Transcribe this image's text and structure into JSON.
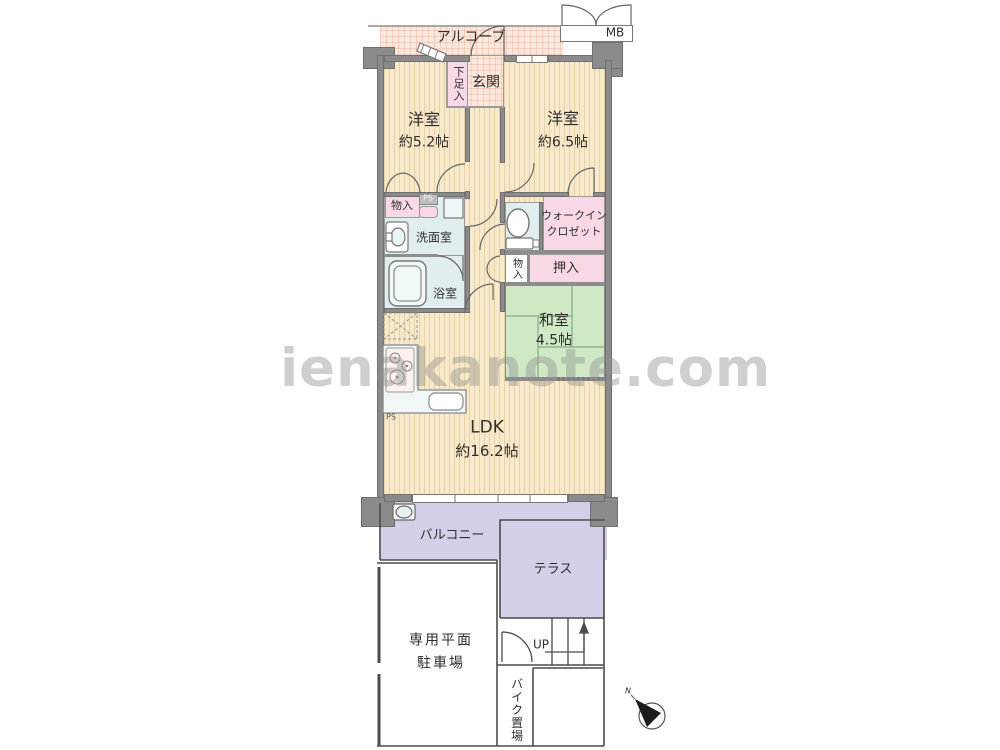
{
  "watermark": "ienakanote.com",
  "compass": {
    "north_label": "N"
  },
  "rooms": {
    "alcove": "アルコーブ",
    "meter_box": "MB",
    "entrance": "玄関",
    "shoe_storage": "下足入",
    "bedroom1": {
      "name": "洋室",
      "size": "約5.2帖"
    },
    "bedroom2": {
      "name": "洋室",
      "size": "約6.5帖"
    },
    "storage_west": "物入",
    "pipe_space": "PS",
    "washroom": "洗面室",
    "bathroom": "浴室",
    "walk_in_closet": {
      "line1": "ウォークイン",
      "line2": "クロゼット"
    },
    "storage_hall": "物入",
    "oshiire": "押入",
    "japanese_room": {
      "name": "和室",
      "size": "4.5帖"
    },
    "ldk": {
      "name": "LDK",
      "size": "約16.2帖"
    },
    "balcony": "バルコニー",
    "terrace": "テラス",
    "parking": {
      "line1": "専用平面",
      "line2": "駐車場"
    },
    "stairs_up": "UP",
    "bike_storage": "バイク置場"
  },
  "colors": {
    "wall": "#8b8b8b",
    "room_beige": "#f7e9c9",
    "closet_pink": "#f8d7e6",
    "entrance_peach": "#fbe7de",
    "water_blue": "#e0eef0",
    "tatami_green": "#cfe9c5",
    "outdoor_purple": "#d5cee8"
  }
}
